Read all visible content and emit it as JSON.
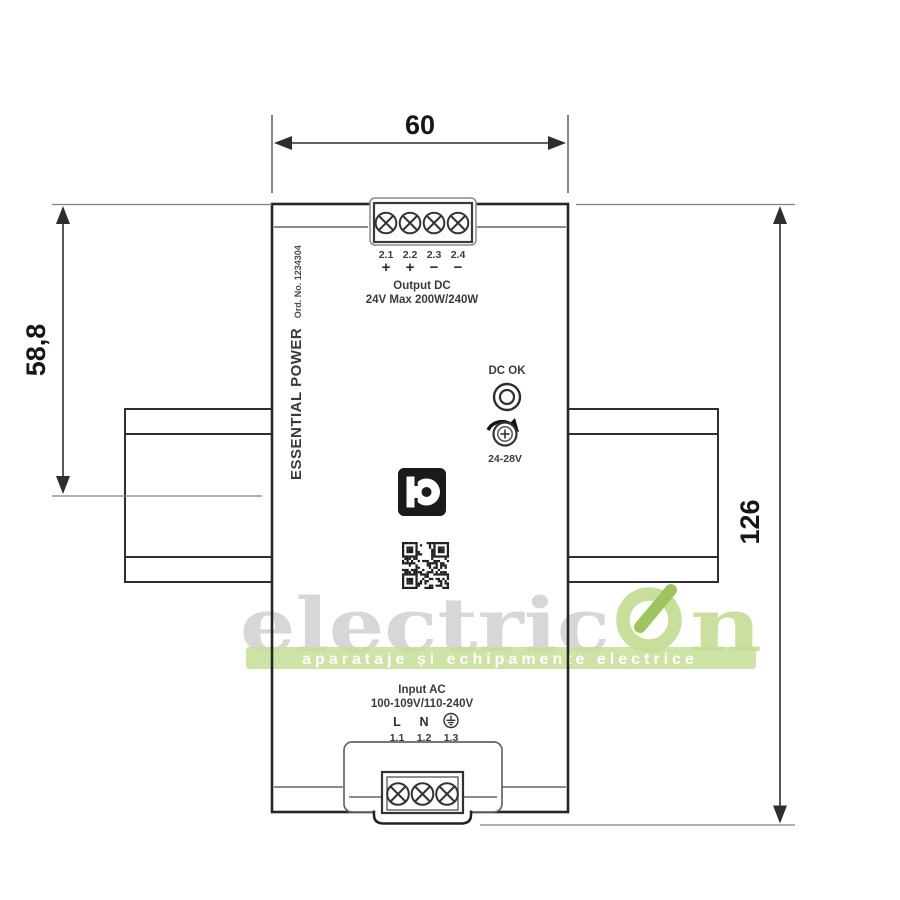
{
  "dimensions": {
    "top_width": "60",
    "left_height": "58,8",
    "right_height": "126"
  },
  "device": {
    "side_label": "ESSENTIAL POWER",
    "side_order_no": "Ord. No. 1234304",
    "output": {
      "terminal_ids": [
        "2.1",
        "2.2",
        "2.3",
        "2.4"
      ],
      "polarities": [
        "+",
        "+",
        "−",
        "−"
      ],
      "title": "Output DC",
      "rating": "24V Max 200W/240W"
    },
    "dc_ok_label": "DC OK",
    "pot_label": "24-28V",
    "input": {
      "title": "Input AC",
      "rating": "100-109V/110-240V",
      "line_label": "L",
      "neutral_label": "N",
      "terminal_ids": [
        "1.1",
        "1.2",
        "1.3"
      ]
    }
  },
  "watermark": {
    "brand_gray": "electric",
    "brand_green_letter": "n",
    "tagline": "aparataje și echipamente electrice",
    "colors": {
      "gray": "#d7d7d7",
      "green_light": "#cbe09e",
      "green_ring": "#c8df9b",
      "green_dark": "#9dc45f",
      "banner": "#c6de96"
    }
  }
}
